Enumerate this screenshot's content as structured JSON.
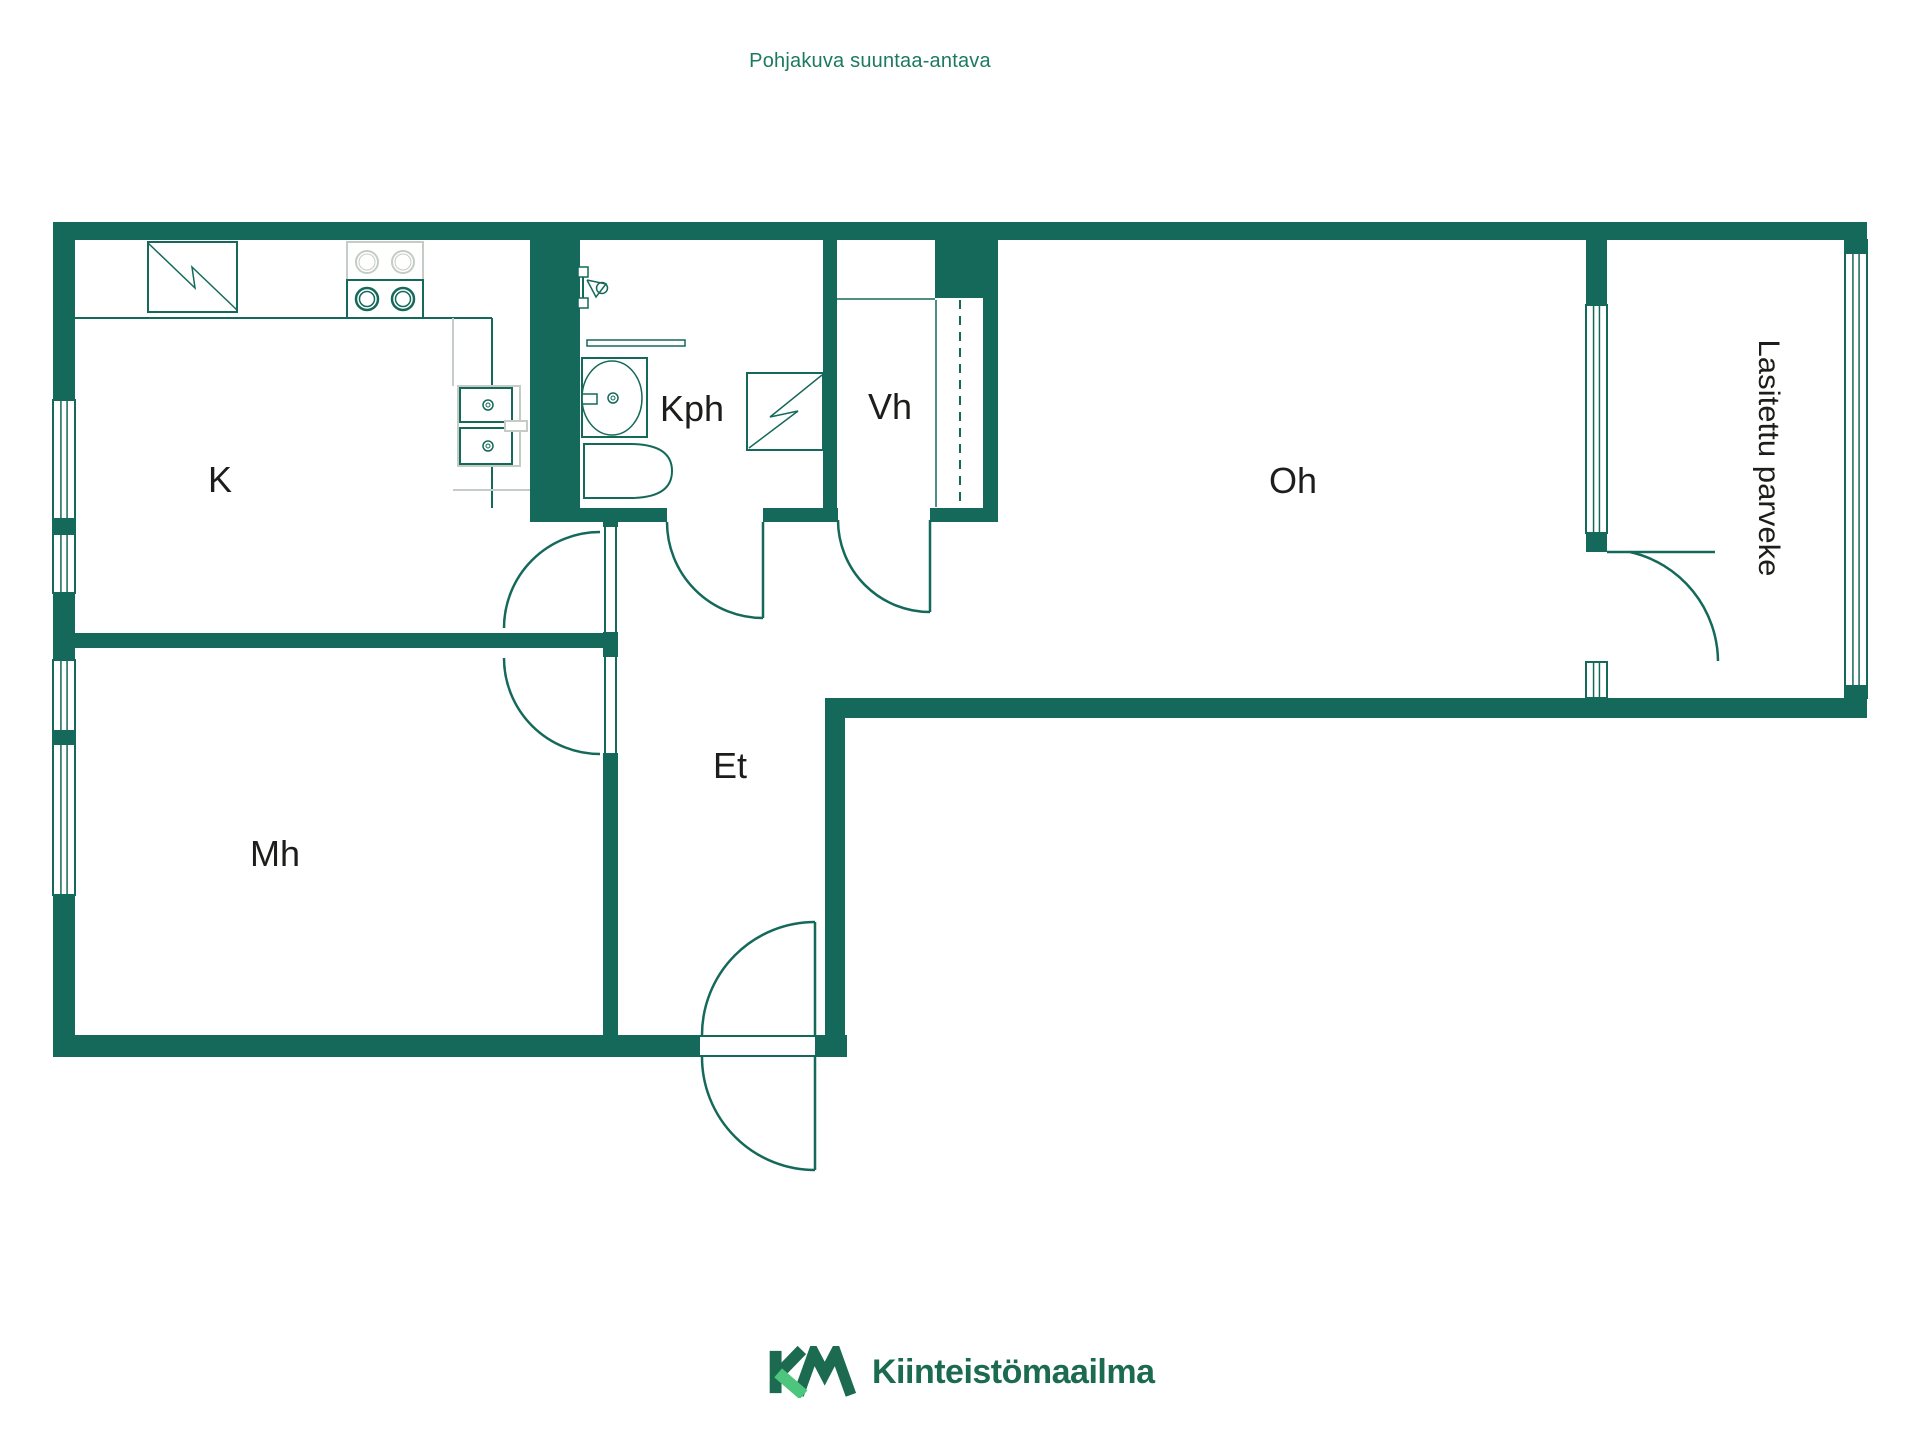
{
  "header": {
    "text": "Pohjakuva suuntaa-antava"
  },
  "footer": {
    "brand": "Kiinteistömaailma"
  },
  "colors": {
    "wall": "#15695A",
    "light": "#c5cbc5",
    "label": "#1d1d1b",
    "header_green": "#1b7a5f",
    "logo_dark": "#1c6b50",
    "logo_light": "#4ec57d",
    "background": "#ffffff"
  },
  "rooms": [
    {
      "id": "K",
      "label": "K",
      "meaning": "kitchen"
    },
    {
      "id": "Kph",
      "label": "Kph",
      "meaning": "bathroom"
    },
    {
      "id": "Vh",
      "label": "Vh",
      "meaning": "closet"
    },
    {
      "id": "Oh",
      "label": "Oh",
      "meaning": "living-room"
    },
    {
      "id": "Et",
      "label": "Et",
      "meaning": "hallway"
    },
    {
      "id": "Mh",
      "label": "Mh",
      "meaning": "bedroom"
    },
    {
      "id": "Parveke",
      "label": "Lasitettu parveke",
      "meaning": "glazed-balcony"
    }
  ],
  "plan": {
    "walls": [
      {
        "name": "wall-top",
        "x": 53,
        "y": 222,
        "w": 1814,
        "h": 18
      },
      {
        "name": "wall-left-upper",
        "x": 53,
        "y": 222,
        "w": 22,
        "h": 178
      },
      {
        "name": "wall-left-mid",
        "x": 53,
        "y": 593,
        "w": 22,
        "h": 67
      },
      {
        "name": "wall-left-lower",
        "x": 53,
        "y": 895,
        "w": 22,
        "h": 162
      },
      {
        "name": "wall-bottom-left",
        "x": 53,
        "y": 1035,
        "w": 647,
        "h": 22
      },
      {
        "name": "wall-bottom-entry-right",
        "x": 815,
        "y": 1035,
        "w": 32,
        "h": 22
      },
      {
        "name": "wall-et-right",
        "x": 825,
        "y": 698,
        "w": 20,
        "h": 359
      },
      {
        "name": "wall-oh-bottom",
        "x": 845,
        "y": 698,
        "w": 741,
        "h": 20
      },
      {
        "name": "wall-balcony-bottom",
        "x": 1586,
        "y": 698,
        "w": 281,
        "h": 20
      },
      {
        "name": "wall-balcony-left-upper",
        "x": 1586,
        "y": 240,
        "w": 21,
        "h": 70
      },
      {
        "name": "wall-balcony-left-mid",
        "x": 1586,
        "y": 528,
        "w": 21,
        "h": 24
      },
      {
        "name": "wall-plumbing",
        "x": 530,
        "y": 240,
        "w": 50,
        "h": 282
      },
      {
        "name": "wall-kph-vh",
        "x": 823,
        "y": 240,
        "w": 14,
        "h": 280
      },
      {
        "name": "wall-vh-top-chunk",
        "x": 935,
        "y": 240,
        "w": 63,
        "h": 58
      },
      {
        "name": "wall-vh-right",
        "x": 983,
        "y": 298,
        "w": 15,
        "h": 222
      },
      {
        "name": "wall-kph-bottom-a",
        "x": 580,
        "y": 508,
        "w": 87,
        "h": 14
      },
      {
        "name": "wall-kph-bottom-b",
        "x": 763,
        "y": 508,
        "w": 75,
        "h": 14
      },
      {
        "name": "wall-vh-bottom",
        "x": 930,
        "y": 508,
        "w": 68,
        "h": 14
      },
      {
        "name": "wall-et-left-a",
        "x": 603,
        "y": 510,
        "w": 15,
        "h": 17
      },
      {
        "name": "wall-et-left-b",
        "x": 603,
        "y": 632,
        "w": 15,
        "h": 25
      },
      {
        "name": "wall-et-left-c",
        "x": 603,
        "y": 753,
        "w": 15,
        "h": 282
      },
      {
        "name": "wall-k-mh",
        "x": 75,
        "y": 633,
        "w": 528,
        "h": 15
      }
    ],
    "windows": [
      {
        "name": "window-k",
        "x": 53,
        "y": 400,
        "w": 22,
        "h": 193
      },
      {
        "name": "window-mh",
        "x": 53,
        "y": 660,
        "w": 22,
        "h": 235
      },
      {
        "name": "window-oh-balcony",
        "x": 1586,
        "y": 305,
        "w": 21,
        "h": 228
      },
      {
        "name": "window-balcony-door-side",
        "x": 1586,
        "y": 662,
        "w": 21,
        "h": 36
      },
      {
        "name": "window-balcony-glazing",
        "x": 1845,
        "y": 240,
        "w": 22,
        "h": 458
      }
    ],
    "wall_caps": [
      {
        "name": "cap-window-k",
        "x": 53,
        "y": 518,
        "w": 22,
        "h": 17
      },
      {
        "name": "cap-window-mh",
        "x": 53,
        "y": 730,
        "w": 22,
        "h": 15
      },
      {
        "name": "cap-glazing-top",
        "x": 1845,
        "y": 240,
        "w": 22,
        "h": 14
      },
      {
        "name": "cap-glazing-bottom",
        "x": 1845,
        "y": 685,
        "w": 22,
        "h": 13
      }
    ],
    "lines": [
      {
        "name": "counter-front-edge",
        "x1": 75,
        "y1": 318,
        "x2": 492,
        "y2": 318,
        "c": "wall",
        "w": 2
      },
      {
        "name": "counter-right-edge",
        "x1": 492,
        "y1": 318,
        "x2": 492,
        "y2": 508,
        "c": "wall",
        "w": 2
      },
      {
        "name": "counter-inner-edge",
        "x1": 453,
        "y1": 318,
        "x2": 453,
        "y2": 386,
        "c": "light",
        "w": 2
      },
      {
        "name": "counter-base-line",
        "x1": 453,
        "y1": 490,
        "x2": 530,
        "y2": 490,
        "c": "light",
        "w": 2
      },
      {
        "name": "fridge-base-line",
        "x1": 148,
        "y1": 312,
        "x2": 237,
        "y2": 312,
        "c": "wall",
        "w": 1.5
      },
      {
        "name": "vh-shelf-line",
        "x1": 837,
        "y1": 299,
        "x2": 935,
        "y2": 299,
        "c": "wall",
        "w": 1.5
      },
      {
        "name": "vh-closet-line",
        "x1": 936,
        "y1": 300,
        "x2": 936,
        "y2": 507,
        "c": "wall",
        "w": 1.5
      },
      {
        "name": "vh-sliding-rail",
        "x1": 960,
        "y1": 300,
        "x2": 960,
        "y2": 505,
        "c": "wall",
        "w": 2,
        "dash": "9 7"
      },
      {
        "name": "entry-threshold-inner",
        "x1": 700,
        "y1": 1036,
        "x2": 815,
        "y2": 1036,
        "c": "wall",
        "w": 2
      },
      {
        "name": "entry-threshold-outer",
        "x1": 700,
        "y1": 1056,
        "x2": 815,
        "y2": 1056,
        "c": "wall",
        "w": 2
      },
      {
        "name": "door-k-frame-left",
        "x1": 605,
        "y1": 527,
        "x2": 605,
        "y2": 632,
        "c": "wall",
        "w": 2
      },
      {
        "name": "door-k-frame-right",
        "x1": 616,
        "y1": 527,
        "x2": 616,
        "y2": 632,
        "c": "wall",
        "w": 2
      },
      {
        "name": "door-mh-frame-left",
        "x1": 605,
        "y1": 657,
        "x2": 605,
        "y2": 753,
        "c": "wall",
        "w": 2
      },
      {
        "name": "door-mh-frame-right",
        "x1": 616,
        "y1": 657,
        "x2": 616,
        "y2": 753,
        "c": "wall",
        "w": 2
      },
      {
        "name": "door-kph-leaf",
        "x1": 763,
        "y1": 522,
        "x2": 763,
        "y2": 618,
        "c": "wall",
        "w": 2.5
      },
      {
        "name": "door-vh-leaf",
        "x1": 930,
        "y1": 520,
        "x2": 930,
        "y2": 612,
        "c": "wall",
        "w": 2.5
      },
      {
        "name": "door-balcony-leaf",
        "x1": 1607,
        "y1": 552,
        "x2": 1715,
        "y2": 552,
        "c": "wall",
        "w": 2.5
      },
      {
        "name": "door-entry-inner-leaf",
        "x1": 815,
        "y1": 922,
        "x2": 815,
        "y2": 1035,
        "c": "wall",
        "w": 2.5
      },
      {
        "name": "door-entry-outer-leaf",
        "x1": 815,
        "y1": 1057,
        "x2": 815,
        "y2": 1170,
        "c": "wall",
        "w": 2.5
      },
      {
        "name": "washbasin-divider",
        "x1": 615,
        "y1": 358,
        "x2": 615,
        "y2": 437,
        "c": "wall",
        "w": 1.5
      },
      {
        "name": "toilet-divider",
        "x1": 607,
        "y1": 444,
        "x2": 607,
        "y2": 498,
        "c": "wall",
        "w": 1.5
      },
      {
        "name": "shower-rail",
        "x1": 583,
        "y1": 267,
        "x2": 583,
        "y2": 308,
        "c": "wall",
        "w": 2
      },
      {
        "name": "sink-faucet-stem",
        "x1": 493,
        "y1": 426,
        "x2": 505,
        "y2": 426,
        "c": "light",
        "w": 2
      }
    ],
    "arcs": [
      {
        "name": "arc-door-k",
        "d": "M 504 628 A 96 96 0 0 1 600 532"
      },
      {
        "name": "arc-door-mh",
        "d": "M 504 658 A 96 96 0 0 0 600 754"
      },
      {
        "name": "arc-door-kph",
        "d": "M 667 522 A 96 96 0 0 0 763 618"
      },
      {
        "name": "arc-door-vh",
        "d": "M 838 520 A 92 92 0 0 0 930 612"
      },
      {
        "name": "arc-door-balcony",
        "d": "M 1630 552 A 113 113 0 0 1 1718 661"
      },
      {
        "name": "arc-door-entry-inner",
        "d": "M 702 1035 A 113 113 0 0 1 815 922"
      },
      {
        "name": "arc-door-entry-outer",
        "d": "M 702 1057 A 113 113 0 0 0 815 1170"
      }
    ],
    "rects": [
      {
        "name": "fridge-box",
        "x": 148,
        "y": 242,
        "w": 89,
        "h": 70,
        "s": "wall",
        "sw": 2
      },
      {
        "name": "stove-top-box",
        "x": 347,
        "y": 242,
        "w": 76,
        "h": 38,
        "s": "light",
        "sw": 2
      },
      {
        "name": "stove-bottom-box",
        "x": 347,
        "y": 280,
        "w": 76,
        "h": 38,
        "s": "wall",
        "sw": 2
      },
      {
        "name": "sink-cabinet",
        "x": 458,
        "y": 386,
        "w": 62,
        "h": 80,
        "s": "light",
        "sw": 2
      },
      {
        "name": "sink-bowl-upper",
        "x": 460,
        "y": 388,
        "w": 52,
        "h": 34,
        "s": "wall",
        "sw": 2
      },
      {
        "name": "sink-bowl-lower",
        "x": 460,
        "y": 428,
        "w": 52,
        "h": 36,
        "s": "wall",
        "sw": 2
      },
      {
        "name": "sink-faucet",
        "x": 505,
        "y": 421,
        "w": 22,
        "h": 10,
        "s": "light",
        "sw": 2
      },
      {
        "name": "washbasin-box",
        "x": 582,
        "y": 358,
        "w": 65,
        "h": 79,
        "s": "wall",
        "sw": 2
      },
      {
        "name": "washbasin-tap",
        "x": 582,
        "y": 394,
        "w": 15,
        "h": 10,
        "s": "wall",
        "sw": 1.5
      },
      {
        "name": "washing-machine",
        "x": 747,
        "y": 373,
        "w": 76,
        "h": 77,
        "s": "wall",
        "sw": 2
      },
      {
        "name": "shower-bracket-top",
        "x": 578,
        "y": 267,
        "w": 10,
        "h": 10,
        "s": "wall",
        "sw": 1.5
      },
      {
        "name": "shower-bracket-bottom",
        "x": 578,
        "y": 298,
        "w": 10,
        "h": 10,
        "s": "wall",
        "sw": 1.5
      },
      {
        "name": "toilet-button",
        "x": 588,
        "y": 464,
        "w": 8,
        "h": 14,
        "s": "wall",
        "sw": 1.5
      }
    ],
    "paths": [
      {
        "name": "toilet-body",
        "d": "M 584 444 L 630 444 Q 672 444 672 471 Q 672 498 630 498 L 584 498 Z",
        "s": "wall",
        "sw": 2,
        "f": "#ffffff"
      },
      {
        "name": "towel-rail",
        "d": "M 587 340 L 685 340 L 685 346 L 587 346 Z",
        "s": "wall",
        "sw": 1.5,
        "f": "#ffffff"
      }
    ],
    "polylines": [
      {
        "name": "fridge-zigzag",
        "pts": "148,243 195,288 192,267 237,310",
        "s": "wall",
        "sw": 1.5
      },
      {
        "name": "washing-machine-zigzag",
        "pts": "822,375 770,417 798,411 749,448",
        "s": "wall",
        "sw": 1.5
      },
      {
        "name": "shower-cone",
        "pts": "587,280 606,284 596,297 587,280",
        "s": "wall",
        "sw": 1.5
      }
    ],
    "ellipses": [
      {
        "name": "washbasin-bowl",
        "cx": 612,
        "cy": 398,
        "rx": 30,
        "ry": 37,
        "s": "wall",
        "sw": 1.5
      }
    ],
    "circles": [
      {
        "name": "burner-light-1",
        "cx": 367,
        "cy": 262,
        "r": 11,
        "s": "light",
        "sw": 2
      },
      {
        "name": "burner-light-1-inner",
        "cx": 367,
        "cy": 262,
        "r": 8,
        "s": "light",
        "sw": 1
      },
      {
        "name": "burner-light-2",
        "cx": 403,
        "cy": 262,
        "r": 11,
        "s": "light",
        "sw": 2
      },
      {
        "name": "burner-light-2-inner",
        "cx": 403,
        "cy": 262,
        "r": 8,
        "s": "light",
        "sw": 1
      },
      {
        "name": "burner-green-1",
        "cx": 367,
        "cy": 299,
        "r": 11,
        "s": "wall",
        "sw": 2.5
      },
      {
        "name": "burner-green-1-inner",
        "cx": 367,
        "cy": 299,
        "r": 7.5,
        "s": "wall",
        "sw": 1.5
      },
      {
        "name": "burner-green-2",
        "cx": 403,
        "cy": 299,
        "r": 11,
        "s": "wall",
        "sw": 2.5
      },
      {
        "name": "burner-green-2-inner",
        "cx": 403,
        "cy": 299,
        "r": 7.5,
        "s": "wall",
        "sw": 1.5
      },
      {
        "name": "sink-drain-1",
        "cx": 488,
        "cy": 405,
        "r": 5,
        "s": "wall",
        "sw": 1.5
      },
      {
        "name": "sink-drain-1-inner",
        "cx": 488,
        "cy": 405,
        "r": 2,
        "s": "wall",
        "sw": 1
      },
      {
        "name": "sink-drain-2",
        "cx": 488,
        "cy": 446,
        "r": 5,
        "s": "wall",
        "sw": 1.5
      },
      {
        "name": "sink-drain-2-inner",
        "cx": 488,
        "cy": 446,
        "r": 2,
        "s": "wall",
        "sw": 1
      },
      {
        "name": "washbasin-drain",
        "cx": 613,
        "cy": 398,
        "r": 5,
        "s": "wall",
        "sw": 1.5
      },
      {
        "name": "washbasin-drain-inner",
        "cx": 613,
        "cy": 398,
        "r": 2,
        "s": "wall",
        "sw": 1
      },
      {
        "name": "shower-head",
        "cx": 602,
        "cy": 288,
        "r": 5.5,
        "s": "wall",
        "sw": 1.5
      }
    ],
    "labels": [
      {
        "name": "room-label-k",
        "text": "K",
        "x": 220,
        "y": 492,
        "size": 36
      },
      {
        "name": "room-label-kph",
        "text": "Kph",
        "x": 692,
        "y": 421,
        "size": 36
      },
      {
        "name": "room-label-vh",
        "text": "Vh",
        "x": 890,
        "y": 419,
        "size": 36
      },
      {
        "name": "room-label-oh",
        "text": "Oh",
        "x": 1293,
        "y": 493,
        "size": 36
      },
      {
        "name": "room-label-et",
        "text": "Et",
        "x": 730,
        "y": 778,
        "size": 36
      },
      {
        "name": "room-label-mh",
        "text": "Mh",
        "x": 275,
        "y": 866,
        "size": 36
      },
      {
        "name": "room-label-parveke",
        "text": "Lasitettu parveke",
        "x": 1770,
        "y": 458,
        "size": 30,
        "rotate": 90,
        "dy": 11,
        "textLength": 237
      }
    ]
  }
}
